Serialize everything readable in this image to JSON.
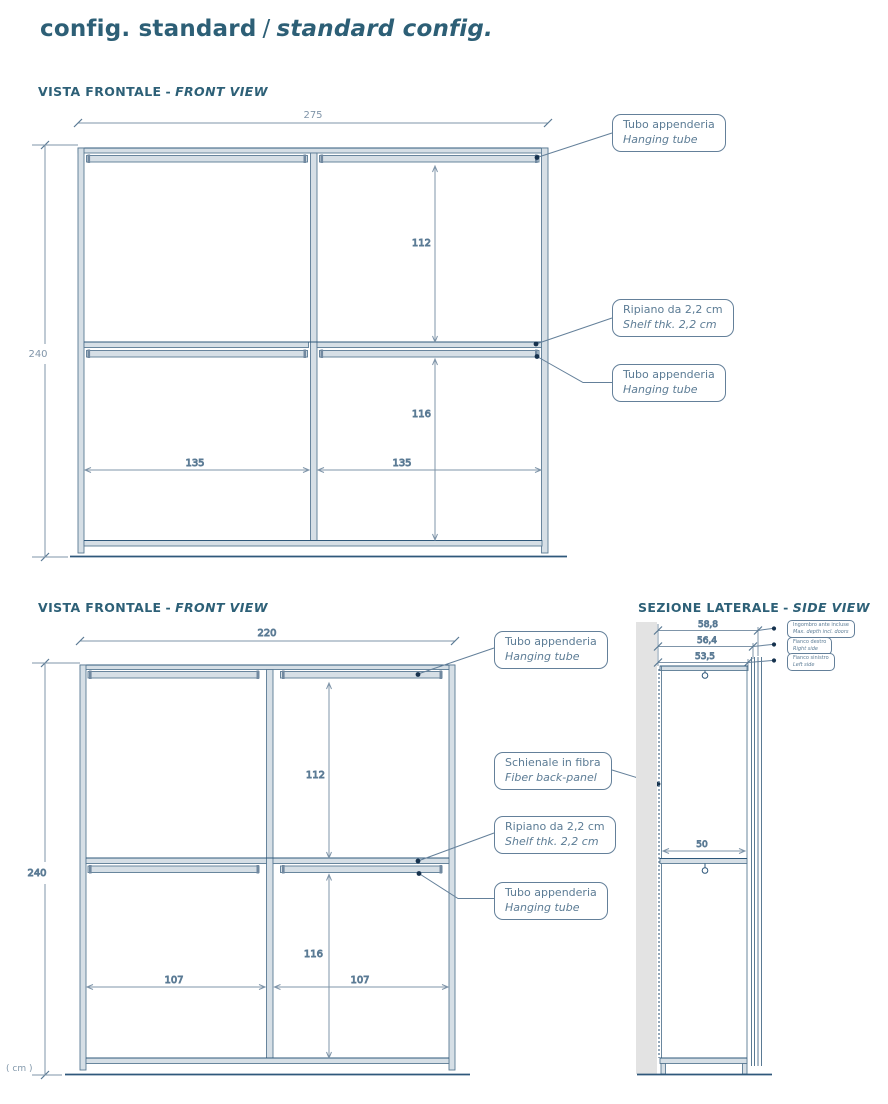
{
  "title": {
    "it": "config. standard",
    "sep": "/",
    "en": "standard config."
  },
  "unit_note": "( cm )",
  "fv1": {
    "heading": {
      "it": "VISTA FRONTALE",
      "sep": "-",
      "en": "FRONT VIEW"
    },
    "dims": {
      "width": "275",
      "height": "240",
      "upper_height": "112",
      "lower_height": "116",
      "bay_left": "135",
      "bay_right": "135"
    },
    "callout_tube_top": {
      "it": "Tubo appenderia",
      "en": "Hanging tube"
    },
    "callout_shelf": {
      "it": "Ripiano da 2,2 cm",
      "en": "Shelf thk. 2,2 cm"
    },
    "callout_tube_mid": {
      "it": "Tubo appenderia",
      "en": "Hanging tube"
    }
  },
  "fv2": {
    "heading": {
      "it": "VISTA FRONTALE",
      "sep": "-",
      "en": "FRONT VIEW"
    },
    "dims": {
      "width": "220",
      "height": "240",
      "upper_height": "112",
      "lower_height": "116",
      "bay_left": "107",
      "bay_right": "107"
    },
    "callout_tube_top": {
      "it": "Tubo appenderia",
      "en": "Hanging tube"
    },
    "callout_back_panel": {
      "it": "Schienale in fibra",
      "en": "Fiber back-panel"
    },
    "callout_shelf": {
      "it": "Ripiano da 2,2 cm",
      "en": "Shelf thk. 2,2 cm"
    },
    "callout_tube_mid": {
      "it": "Tubo appenderia",
      "en": "Hanging tube"
    }
  },
  "sv": {
    "heading": {
      "it": "SEZIONE LATERALE",
      "sep": "-",
      "en": "SIDE VIEW"
    },
    "dims": {
      "depth_doors": "58,8",
      "depth_right": "56,4",
      "depth_left": "53,5",
      "shelf_depth": "50"
    },
    "callout_depth": {
      "it": "Ingombro ante incluse",
      "en": "Max. depth incl. doors"
    },
    "callout_right": {
      "it": "Fianco destro",
      "en": "Right side"
    },
    "callout_left": {
      "it": "Fianco sinistro",
      "en": "Left side"
    }
  },
  "colors": {
    "accent": "#2d6077",
    "line": "#5a7a94",
    "line_dark": "#2f587b",
    "dim_text": "#8095a9",
    "label_text": "#5c7c95",
    "member_fill": "#d6dfe6",
    "wall_gray": "#e3e3e3",
    "dot": "#16324e"
  }
}
